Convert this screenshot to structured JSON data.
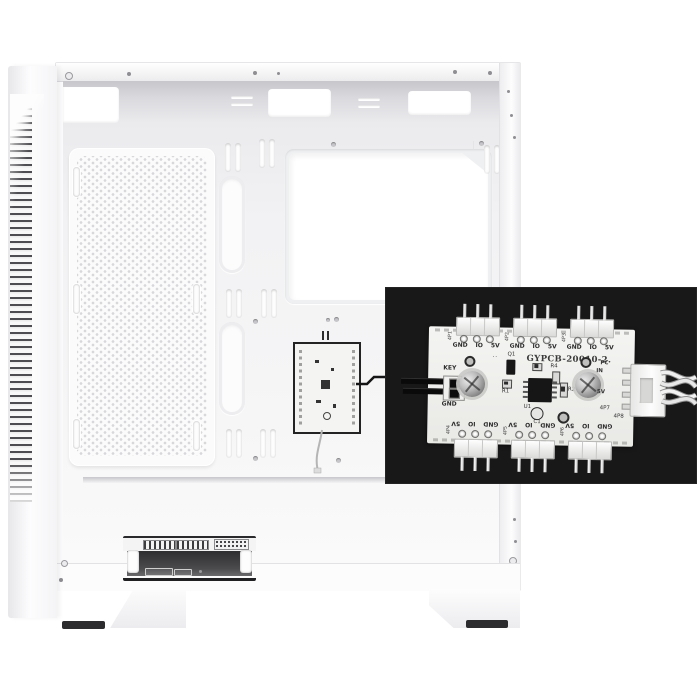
{
  "photo": {
    "subject": "white-pc-case-interior-with-fan-hub-pcb-inset",
    "colors": {
      "case_white": "#fbfbfc",
      "interior_shadow": "#c6c6cb",
      "inset_background": "#181818",
      "pcb_white": "#f2f2f0",
      "foot_dark": "#2c2c2e"
    }
  },
  "inset": {
    "board": {
      "model": "GYPCB-20010-2.",
      "pin_labels": [
        "GND",
        "IO",
        "5V"
      ],
      "header_refs_top": [
        "4P1",
        "4P2",
        "4P3"
      ],
      "header_refs_bottom": [
        "4P4",
        "4P5",
        "4P6"
      ],
      "key": {
        "label": "KEY",
        "gnd": "GND"
      },
      "components": {
        "q1": "Q1",
        "r1": "R1",
        "r2": "R2",
        "r4": "R4",
        "u1": "U1",
        "c1": "C1"
      },
      "output": {
        "pc": "PC",
        "in": "IN",
        "v5": "5V",
        "ref": "4P7",
        "ref_board": "4P8"
      }
    }
  }
}
